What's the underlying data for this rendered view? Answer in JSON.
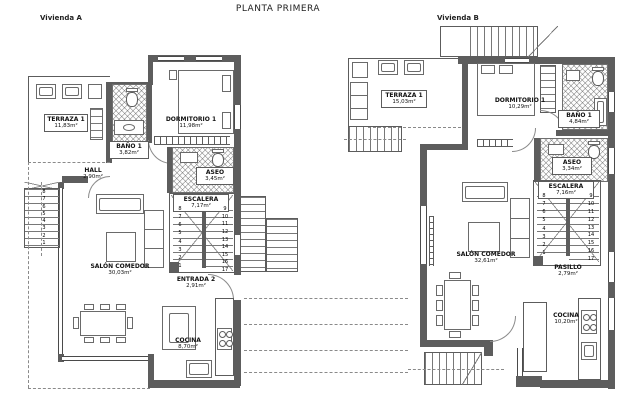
{
  "title": "PLANTA PRIMERA",
  "unit_a": {
    "name": "Vivienda A",
    "rooms": {
      "terraza": {
        "label": "TERRAZA 1",
        "area": "11,83m²"
      },
      "bano": {
        "label": "BAÑO 1",
        "area": "3,82m²"
      },
      "dormitorio": {
        "label": "DORMITORIO 1",
        "area": "11,98m²"
      },
      "hall": {
        "label": "HALL",
        "area": "2,90m²"
      },
      "aseo": {
        "label": "ASEO",
        "area": "3,45m²"
      },
      "escalera": {
        "label": "ESCALERA",
        "area": "7,17m²"
      },
      "salon": {
        "label": "SALÓN COMEDOR",
        "area": "30,03m²"
      },
      "entrada": {
        "label": "ENTRADA 2",
        "area": "2,91m²"
      },
      "cocina": {
        "label": "COCINA",
        "area": "8,70m²"
      }
    },
    "stairs": {
      "inner_left": [
        "8",
        "7",
        "6",
        "5",
        "4",
        "3",
        "2",
        "1"
      ],
      "inner_right": [
        "9",
        "10",
        "11",
        "12",
        "13",
        "14",
        "15",
        "16",
        "17"
      ],
      "outer_left": [
        "8",
        "7",
        "6",
        "5",
        "4",
        "3",
        "2",
        "1"
      ]
    }
  },
  "unit_b": {
    "name": "Vivienda B",
    "rooms": {
      "terraza": {
        "label": "TERRAZA 1",
        "area": "15,03m²"
      },
      "dormitorio": {
        "label": "DORMITORIO 1",
        "area": "10,29m²"
      },
      "bano": {
        "label": "BAÑO 1",
        "area": "4,84m²"
      },
      "aseo": {
        "label": "ASEO",
        "area": "3,34m²"
      },
      "escalera": {
        "label": "ESCALERA",
        "area": "7,16m²"
      },
      "salon": {
        "label": "SALÓN COMEDOR",
        "area": "32,61m²"
      },
      "pasillo": {
        "label": "PASILLO",
        "area": "2,79m²"
      },
      "cocina": {
        "label": "COCINA",
        "area": "10,20m²"
      }
    },
    "stairs": {
      "inner_left": [
        "8",
        "7",
        "6",
        "5",
        "4",
        "3",
        "2",
        "1"
      ],
      "inner_right": [
        "9",
        "10",
        "11",
        "12",
        "13",
        "14",
        "15",
        "16",
        "17"
      ]
    }
  }
}
